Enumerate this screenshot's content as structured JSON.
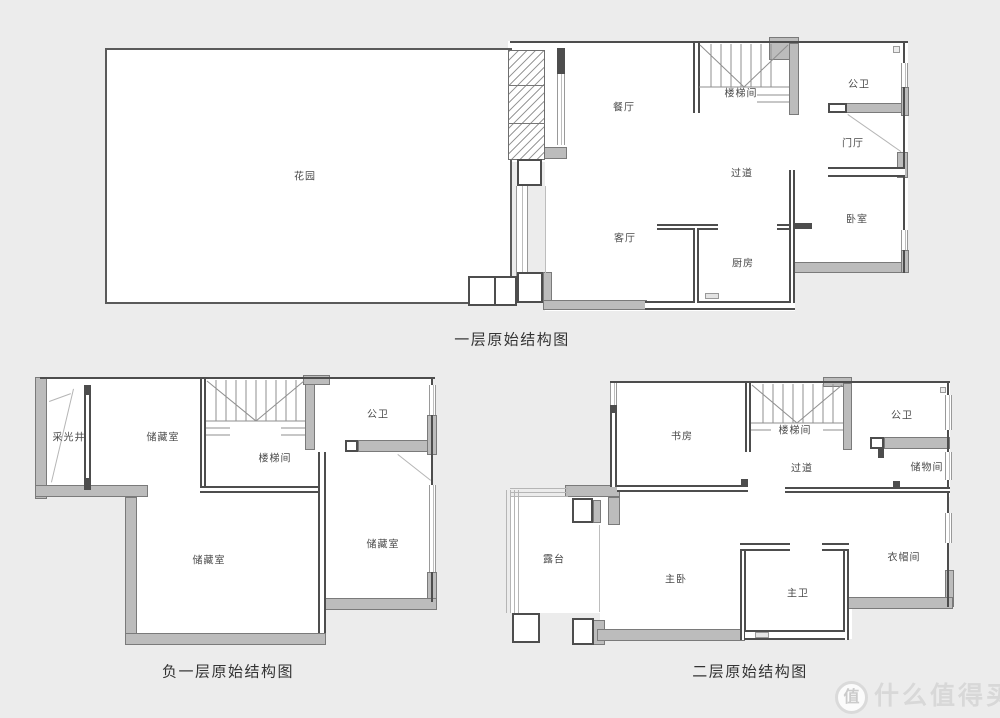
{
  "watermark": {
    "badge": "值",
    "brand": "什么值得买"
  },
  "plans": {
    "floor1": {
      "caption": "一层原始结构图",
      "rooms": {
        "garden": "花园",
        "dining": "餐厅",
        "stairwell": "楼梯间",
        "public_bath": "公卫",
        "foyer": "门厅",
        "hallway": "过道",
        "bedroom": "卧室",
        "living": "客厅",
        "kitchen": "厨房"
      }
    },
    "basement": {
      "caption": "负一层原始结构图",
      "rooms": {
        "light_well": "采光井",
        "storage_top": "储藏室",
        "stairwell": "楼梯间",
        "public_bath": "公卫",
        "storage_mid": "储藏室",
        "storage_right": "储藏室"
      }
    },
    "floor2": {
      "caption": "二层原始结构图",
      "rooms": {
        "study": "书房",
        "stairwell": "楼梯间",
        "public_bath": "公卫",
        "hallway": "过道",
        "storage": "储物间",
        "terrace": "露台",
        "master_bedroom": "主卧",
        "master_bath": "主卫",
        "closet": "衣帽间"
      }
    }
  },
  "colors": {
    "background": "#ececec",
    "wall": "#4d4d4d",
    "gray_wall": "#bcbcbc",
    "label": "#4a4a4a"
  }
}
